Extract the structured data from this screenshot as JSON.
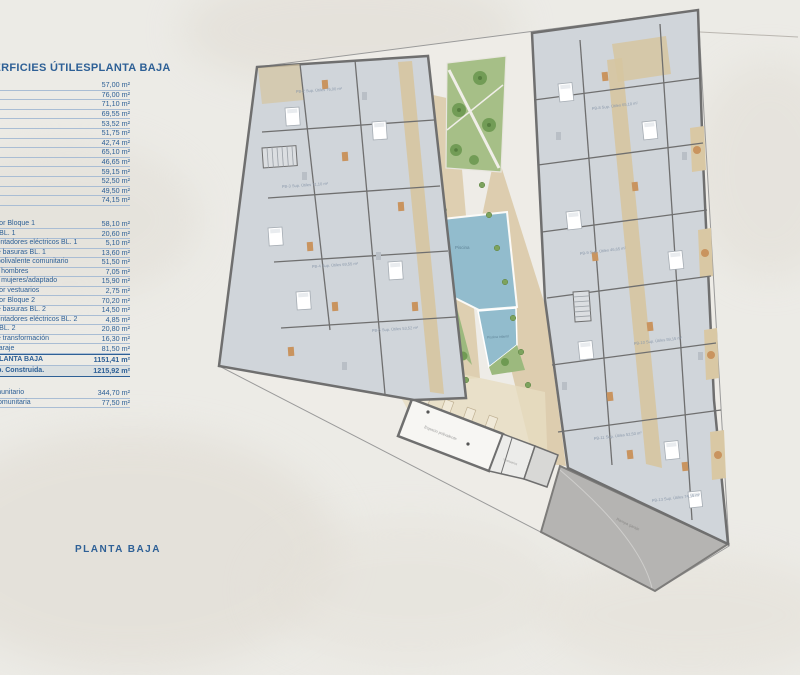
{
  "colors": {
    "accent_blue": "#2e6096",
    "wall_gray": "#6f6f6f",
    "pool_blue": "#92bccd",
    "garden_green": "#a6bf87",
    "patio_tan": "#d8c7a3",
    "ramp_gray": "#b5b4b2",
    "apartment_floor": "#d0d5da"
  },
  "table": {
    "title_left": "SUPERFICIES ÚTILES",
    "title_right": "PLANTA BAJA",
    "group1": [
      {
        "value": "57,00 m²"
      },
      {
        "value": "76,00 m²"
      },
      {
        "value": "71,10 m²"
      },
      {
        "value": "69,55 m²"
      },
      {
        "value": "53,52 m²"
      },
      {
        "value": "51,75 m²"
      },
      {
        "value": "42,74 m²"
      },
      {
        "value": "65,10 m²"
      },
      {
        "value": "46,65 m²"
      },
      {
        "value": "59,15 m²"
      },
      {
        "value": "52,50 m²"
      },
      {
        "value": "49,50 m²"
      },
      {
        "value": "74,15 m²"
      }
    ],
    "group2": [
      {
        "label": "Distribuidor Bloque 1",
        "value": "58,10 m²"
      },
      {
        "label": "Almacén BL. 1",
        "value": "20,60 m²"
      },
      {
        "label": "Cuarto contadores eléctricos BL. 1",
        "value": "5,10 m²"
      },
      {
        "label": "Cuarto de basuras BL. 1",
        "value": "13,60 m²"
      },
      {
        "label": "Espacio polivalente comunitario",
        "value": "51,50 m²"
      },
      {
        "label": "Vestuario hombres",
        "value": "7,05 m²"
      },
      {
        "label": "Vestuario mujeres/adaptado",
        "value": "15,90 m²"
      },
      {
        "label": "Distribuidor vestuarios",
        "value": "2,75 m²"
      },
      {
        "label": "Distribuidor Bloque 2",
        "value": "70,20 m²"
      },
      {
        "label": "Cuarto de basuras BL. 2",
        "value": "14,50 m²"
      },
      {
        "label": "Cuarto contadores eléctricos BL. 2",
        "value": "4,85 m²"
      },
      {
        "label": "Almacén BL. 2",
        "value": "20,80 m²"
      },
      {
        "label": "Centro de transformación",
        "value": "16,30 m²"
      },
      {
        "label": "Acceso garaje",
        "value": "81,50 m²"
      }
    ],
    "totals": [
      {
        "label": "TOTAL PLANTA BAJA",
        "value": "1151,41 m²"
      },
      {
        "label": "Total Sup. Construida.",
        "value": "1215,92 m²"
      }
    ],
    "extras": [
      {
        "label": "Patio comunitario",
        "value": "344,70 m²"
      },
      {
        "label": "Piscina comunitaria",
        "value": "77,50 m²"
      }
    ]
  },
  "footer": {
    "title": "PLANTA BAJA"
  },
  "plan": {
    "labels": {
      "pool": "Piscina",
      "small_pool": "Piscina infantil",
      "patio": "Patio comunitario",
      "multipurpose": "Espacio polivalente",
      "ramp": "Rampa garaje",
      "vestuarios": "Vestuarios"
    },
    "apartment_labels": [
      "PB-2 Sup. Útiles 76,00 m²",
      "PB-3 Sup. Útiles 71,10 m²",
      "PB-4 Sup. Útiles 69,55 m²",
      "PB-5 Sup. Útiles 53,52 m²",
      "PB-8 Sup. Útiles 65,10 m²",
      "PB-9 Sup. Útiles 46,65 m²",
      "PB-10 Sup. Útiles 59,15 m²",
      "PB-11 Sup. Útiles 52,50 m²",
      "PB-13 Sup. Útiles 74,15 m²"
    ]
  }
}
